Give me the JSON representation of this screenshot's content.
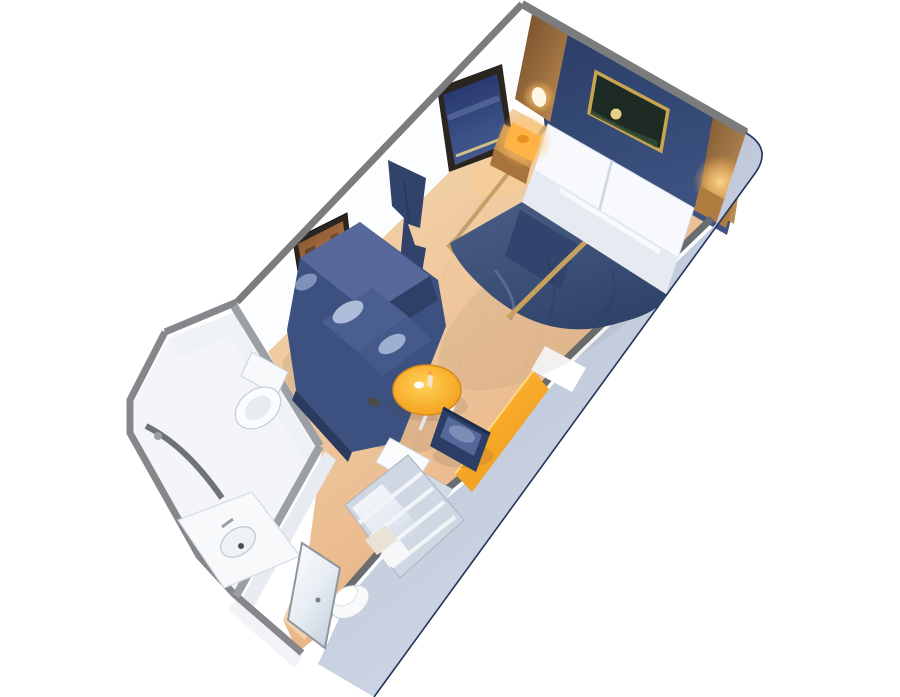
{
  "scene": {
    "kind": "isometric-cutaway-floorplan",
    "subject": "cruise-ship-stateroom",
    "rooms": [
      {
        "name": "sleeping-area"
      },
      {
        "name": "sitting-area"
      },
      {
        "name": "bathroom"
      },
      {
        "name": "entry-corridor"
      },
      {
        "name": "wardrobe-area"
      }
    ],
    "objects": [
      "bed",
      "pillows",
      "bed-divider-runner",
      "nightstand",
      "nightstand-lamp",
      "wall-sconce",
      "headboard-art",
      "window-art",
      "sofa-art",
      "privacy-curtain",
      "loveseat-sofa",
      "coffee-table",
      "side-chair",
      "desk",
      "desk-chair",
      "storage-cabinet",
      "wardrobe-shelves",
      "laundry-bin",
      "toilet",
      "shower",
      "sink-vanity",
      "entry-door"
    ]
  },
  "palette": {
    "background": "#ffffff",
    "wallTopEdge": "#7a7c7e",
    "wallTopEdgeDark": "#6a6d70",
    "partitionEdge": "#9aa0a6",
    "wallFaceWhite": "#fcfdfe",
    "bathWallFace": "#eef1f5",
    "corridorWallFace": "#e8ecf2",
    "outerWallFace": "#f1f3f6",
    "bathFloor": "#f3f5f8",
    "floorWoodMid": "#eec49a",
    "floorSeam": "#9c6a38",
    "bandEdge": "#22335a",
    "navyWall": "#2e4169",
    "woodTrimDark": "#6f4a28",
    "woodTrimLight": "#c08d52",
    "nightstandTop": "#c89250",
    "nightstandFront": "#a6743c",
    "duvetNavy": "#3d5179",
    "duvetDark": "#31436b",
    "pillowWhite": "#f7f9fc",
    "pillowFold": "#e6ebf2",
    "goldTrim": "#c6a05e",
    "sofaBase": "#3c5180",
    "sofaBack": "#56699a",
    "sofaInner": "#2e4068",
    "sofaCushion": "#4a5f8f",
    "sofaCushion2": "#45598a",
    "sofaHighlight": "#b9c9e2",
    "sofaSkirt": "#2b3b60",
    "chairNavy": "#2c3e66",
    "chairStripe": "#54689a",
    "chairHighlight": "#7e92bb",
    "tableRim": "#d9881a",
    "lampBody": "#ffb345",
    "lampCore": "#e88f1f",
    "sconceWhite": "#fff6e4",
    "fixtureWhite": "#f7f9fb",
    "fixtureStroke": "#c6ccd4",
    "basinFill": "#eef1f5",
    "showerWall": "#60646a",
    "closetBody": "#cfd7e2",
    "closetShelf": "#f2f5f8",
    "towelBeige": "#e9e3d7",
    "towelWhite": "#f6f7f8",
    "cabinetGray": "#b9c3d4",
    "cabinetWhite": "#fafbfd",
    "frameDark": "#2b2520",
    "frameGold": "#c9a54f",
    "artRedBlob": "#9c4f3a",
    "horizonGold": "#cfc08a",
    "artGreenDark": "#1e2b24",
    "artMoon": "#e6d088",
    "artHill": "#324a36",
    "curtainNavy": "#31436b",
    "doorLightPool": "#f9e7c8"
  }
}
